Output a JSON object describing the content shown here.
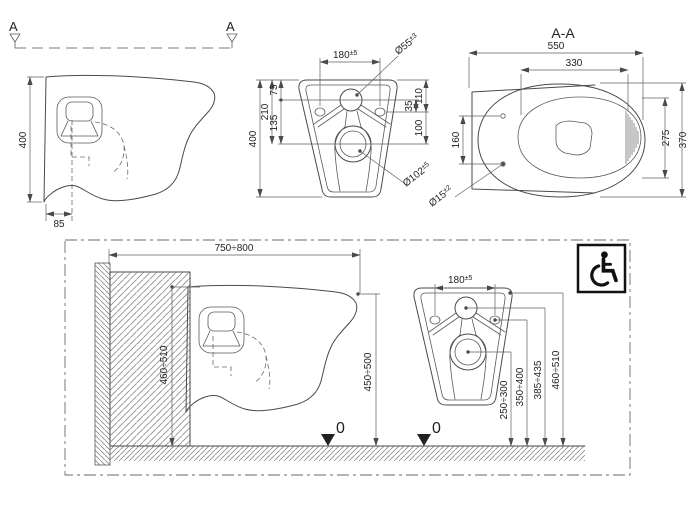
{
  "drawing": {
    "colors": {
      "line": "#4a4a4a",
      "background": "#ffffff",
      "hatch": "#8a8a8a"
    },
    "section_marker": "A",
    "side_view": {
      "height": "400",
      "wall_offset": "85"
    },
    "rear_view": {
      "mount_width": "180",
      "mount_width_tol": "±5",
      "inlet_dia": "Ø55",
      "inlet_dia_tol": "±3",
      "d75": "75",
      "d210": "210",
      "d135": "135",
      "height": "400",
      "d35": "35",
      "d110": "110",
      "d100": "100",
      "outlet_dia": "Ø102",
      "outlet_dia_tol": "±5"
    },
    "section_aa": {
      "title": "A-A",
      "length": "550",
      "bowl_length": "330",
      "hole_spacing": "160",
      "bowl_width": "275",
      "width": "370",
      "hole_dia": "Ø15",
      "hole_dia_tol": "±2"
    },
    "install_side": {
      "depth_range": "750÷800",
      "frame_height": "460÷510",
      "rim_height": "450÷500",
      "level": "0"
    },
    "install_rear": {
      "mount_width": "180",
      "mount_width_tol": "±5",
      "outlet_height": "250÷300",
      "hole_height": "350÷400",
      "inlet_height": "385÷435",
      "rim_height": "460÷510",
      "level": "0"
    },
    "icons": {
      "accessibility": "wheelchair-accessible"
    }
  }
}
